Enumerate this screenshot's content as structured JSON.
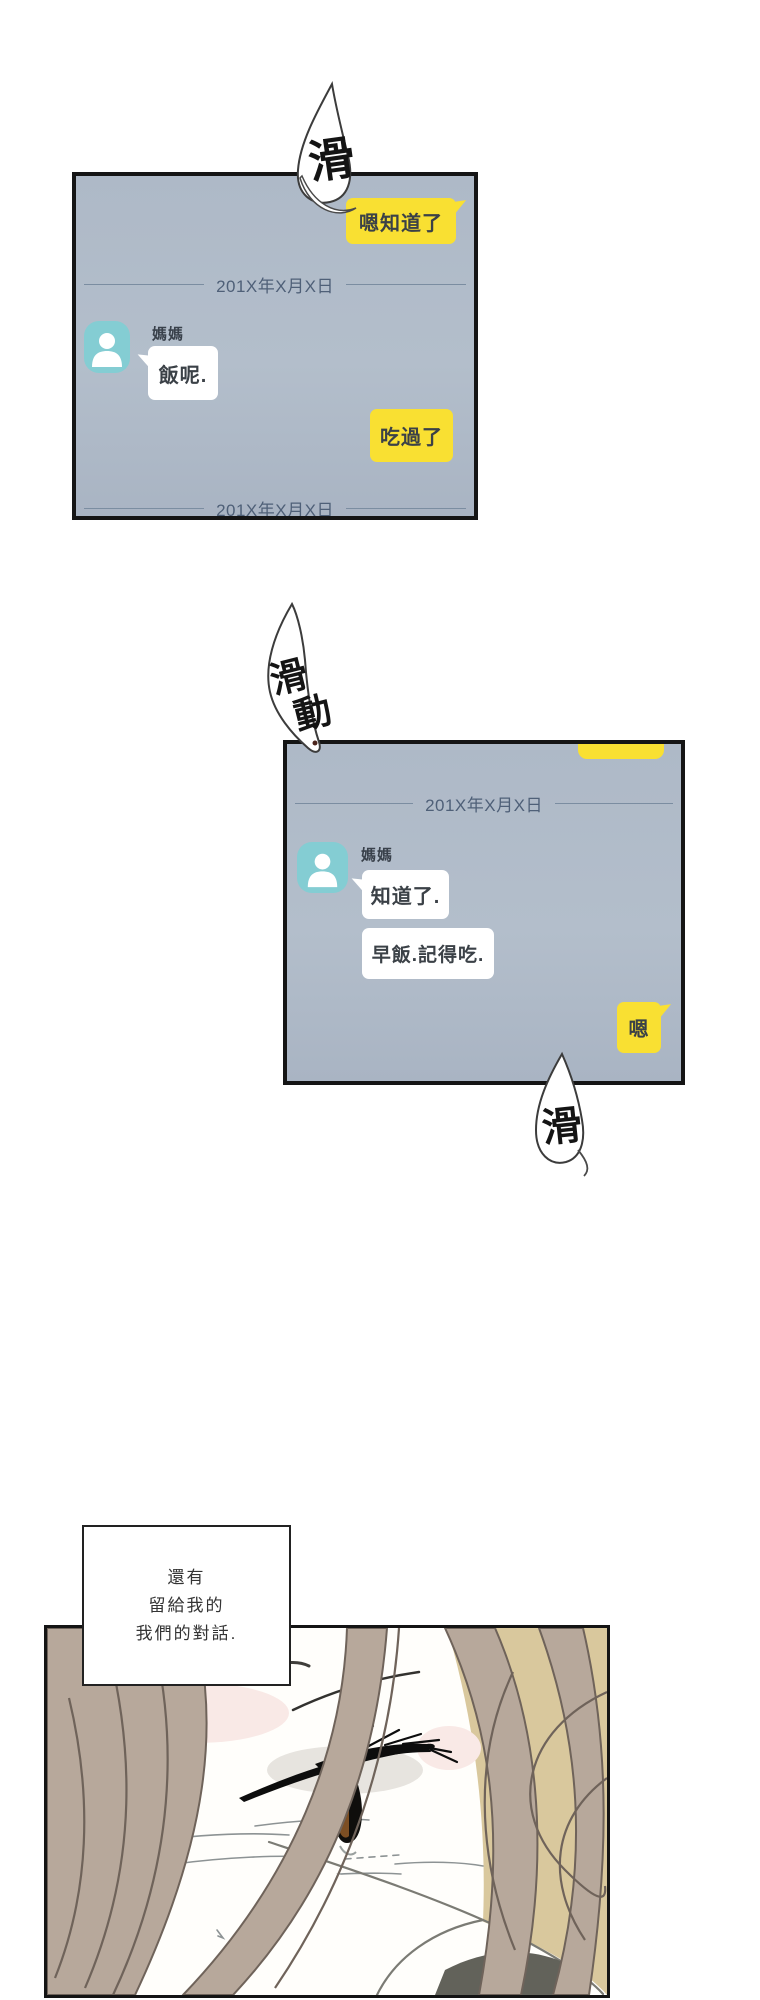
{
  "sfx": {
    "top": "滑",
    "middle": [
      "滑",
      "動"
    ],
    "bottom": "滑"
  },
  "chat1": {
    "outgoing_reply": "嗯知道了",
    "date_top": "201X年X月X日",
    "sender": "媽媽",
    "incoming": "飯呢.",
    "outgoing": "吃過了",
    "date_bottom": "201X年X月X日"
  },
  "chat2": {
    "date": "201X年X月X日",
    "sender": "媽媽",
    "incoming_1": "知道了.",
    "incoming_2": "早飯.記得吃.",
    "outgoing": "嗯"
  },
  "caption": {
    "lines": [
      "還有",
      "留給我的",
      "我們的對話."
    ]
  },
  "colors": {
    "bubble_yellow": "#f9e032",
    "panel_bg": "#aeb9c7",
    "avatar_teal": "#84cdd3",
    "date_text": "#4f6078",
    "bubble_text": "#3b4147"
  }
}
